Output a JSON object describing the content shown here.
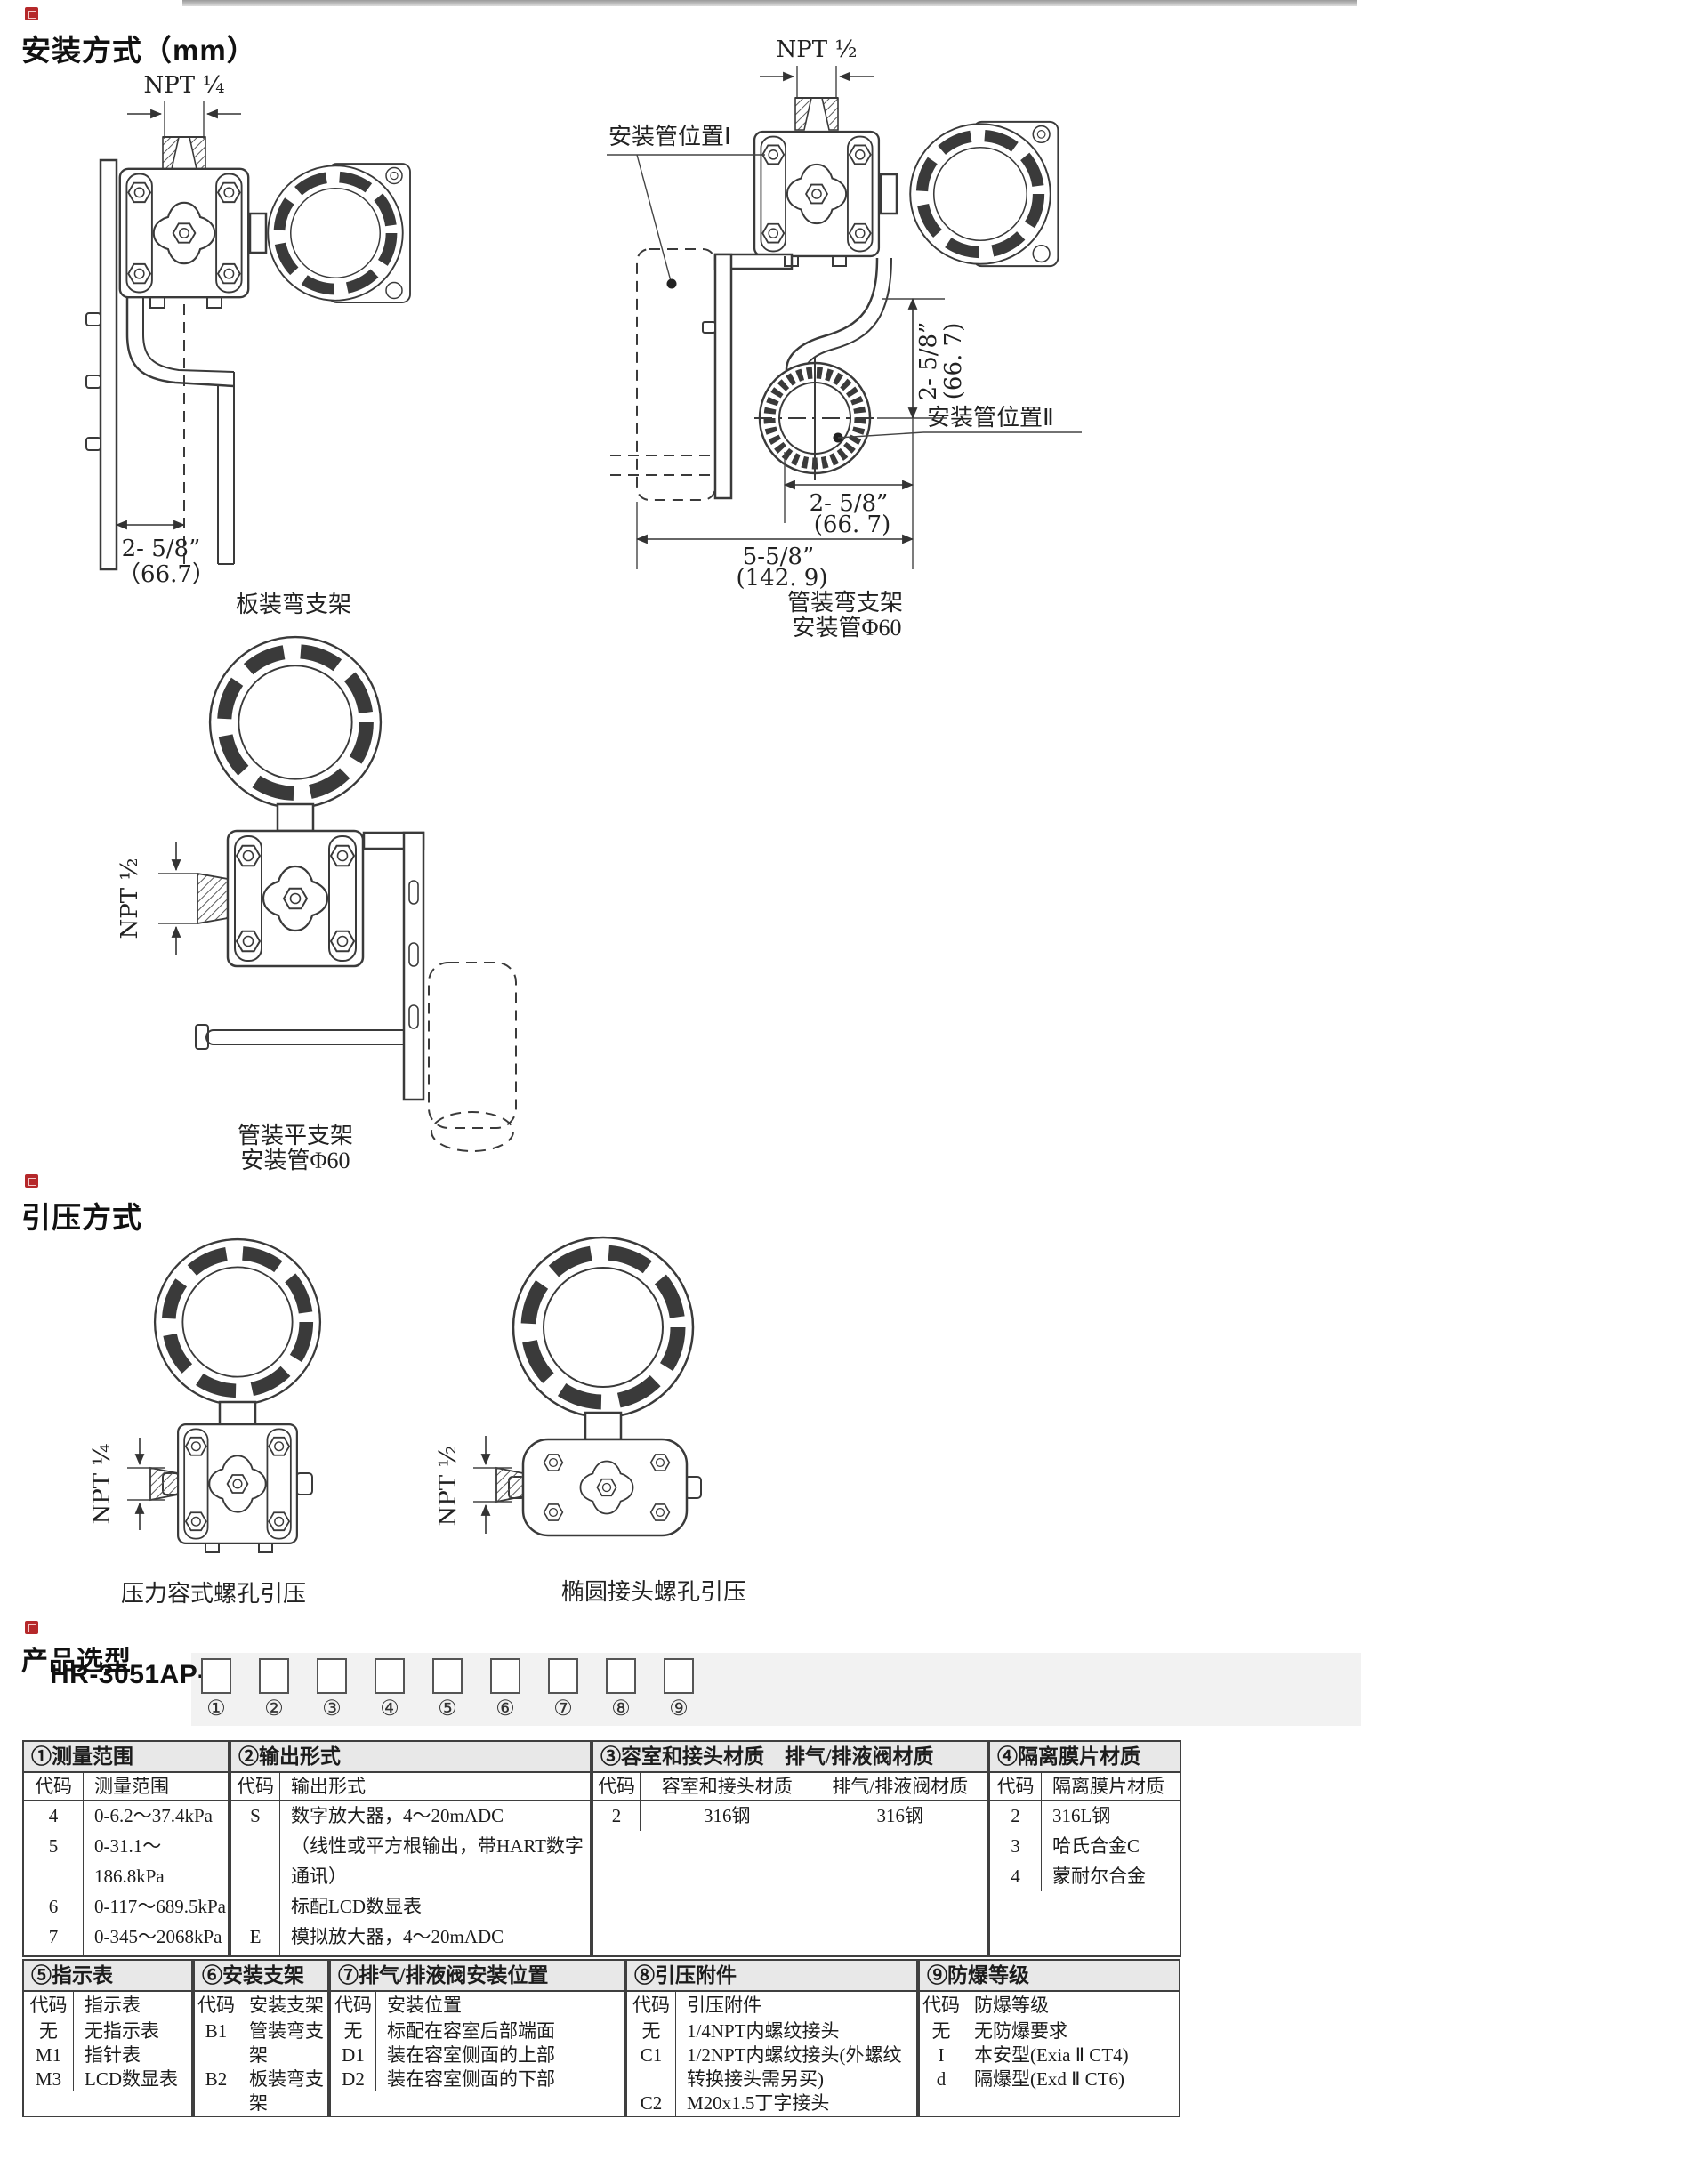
{
  "theme": {
    "accent_red": "#b5282a",
    "table_header_bg": "#e8e8e8",
    "line_color": "#3a3a3a"
  },
  "sections": {
    "install": {
      "title": "安装方式（mm）",
      "drawing1": {
        "npt": "NPT ¼",
        "dim_in": "2- 5/8”",
        "dim_mm": "（66.7）",
        "caption": "板装弯支架"
      },
      "drawing2": {
        "npt": "NPT ½",
        "pos1": "安装管位置Ⅰ",
        "pos2": "安装管位置Ⅱ",
        "dimv_in": "2- 5/8”",
        "dimv_mm": "(66. 7)",
        "dim1_in": "2- 5/8”",
        "dim1_mm": "(66. 7)",
        "dim2_in": "5-5/8”",
        "dim2_mm": "(142. 9)",
        "cap1": "管装弯支架",
        "cap2": "安装管Φ60"
      },
      "drawing3": {
        "npt": "NPT ½",
        "cap1": "管装平支架",
        "cap2": "安装管Φ60"
      }
    },
    "pressure": {
      "title": "引压方式",
      "drawing4": {
        "npt": "NPT ¼",
        "caption": "压力容式螺孔引压"
      },
      "drawing5": {
        "npt": "NPT ½",
        "caption": "椭圆接头螺孔引压"
      }
    },
    "selection": {
      "title": "产品选型",
      "model_prefix": "HR-3051AP-",
      "slots": [
        "①",
        "②",
        "③",
        "④",
        "⑤",
        "⑥",
        "⑦",
        "⑧",
        "⑨"
      ]
    }
  },
  "tables": {
    "t1": {
      "title": "①测量范围",
      "headers": [
        "代码",
        "测量范围"
      ],
      "rows": [
        [
          "4",
          "0-6.2～37.4kPa"
        ],
        [
          "5",
          "0-31.1～186.8kPa"
        ],
        [
          "6",
          "0-117～689.5kPa"
        ],
        [
          "7",
          "0-345～2068kPa"
        ],
        [
          "8",
          "0-1170～6895kPa"
        ]
      ]
    },
    "t2": {
      "title": "②输出形式",
      "headers": [
        "代码",
        "输出形式"
      ],
      "rows": [
        [
          "S",
          "数字放大器，4～20mADC\n（线性或平方根输出，带HART数字通讯）\n标配LCD数显表"
        ],
        [
          "E",
          "模拟放大器，4～20mADC\n线性输出（指针表或LCD数显表另选）"
        ]
      ]
    },
    "t3": {
      "title": "③容室和接头材质　排气/排液阀材质",
      "headers": [
        "代码",
        "容室和接头材质",
        "排气/排液阀材质"
      ],
      "rows": [
        [
          "2",
          "316钢",
          "316钢"
        ]
      ]
    },
    "t4": {
      "title": "④隔离膜片材质",
      "headers": [
        "代码",
        "隔离膜片材质"
      ],
      "rows": [
        [
          "2",
          "316L钢"
        ],
        [
          "3",
          "哈氏合金C"
        ],
        [
          "4",
          "蒙耐尔合金"
        ]
      ]
    },
    "t5": {
      "title": "⑤指示表",
      "headers": [
        "代码",
        "指示表"
      ],
      "rows": [
        [
          "无",
          "无指示表"
        ],
        [
          "M1",
          "指针表"
        ],
        [
          "M3",
          "LCD数显表"
        ]
      ]
    },
    "t6": {
      "title": "⑥安装支架",
      "headers": [
        "代码",
        "安装支架"
      ],
      "rows": [
        [
          "B1",
          "管装弯支架"
        ],
        [
          "B2",
          "板装弯支架"
        ],
        [
          "B3",
          "管装平支架"
        ]
      ]
    },
    "t7": {
      "title": "⑦排气/排液阀安装位置",
      "headers": [
        "代码",
        "安装位置"
      ],
      "rows": [
        [
          "无",
          "标配在容室后部端面"
        ],
        [
          "D1",
          "装在容室侧面的上部"
        ],
        [
          "D2",
          "装在容室侧面的下部"
        ]
      ]
    },
    "t8": {
      "title": "⑧引压附件",
      "headers": [
        "代码",
        "引压附件"
      ],
      "rows": [
        [
          "无",
          "1/4NPT内螺纹接头"
        ],
        [
          "C1",
          "1/2NPT内螺纹接头(外螺纹转换接头需另买)"
        ],
        [
          "C2",
          "M20x1.5丁字接头"
        ],
        [
          "C3",
          "1/4英寸NPT外螺纹接头"
        ]
      ]
    },
    "t9": {
      "title": "⑨防爆等级",
      "headers": [
        "代码",
        "防爆等级"
      ],
      "rows": [
        [
          "无",
          "无防爆要求"
        ],
        [
          "I",
          "本安型(Exia Ⅱ CT4)"
        ],
        [
          "d",
          "隔爆型(Exd Ⅱ CT6)"
        ]
      ]
    }
  }
}
